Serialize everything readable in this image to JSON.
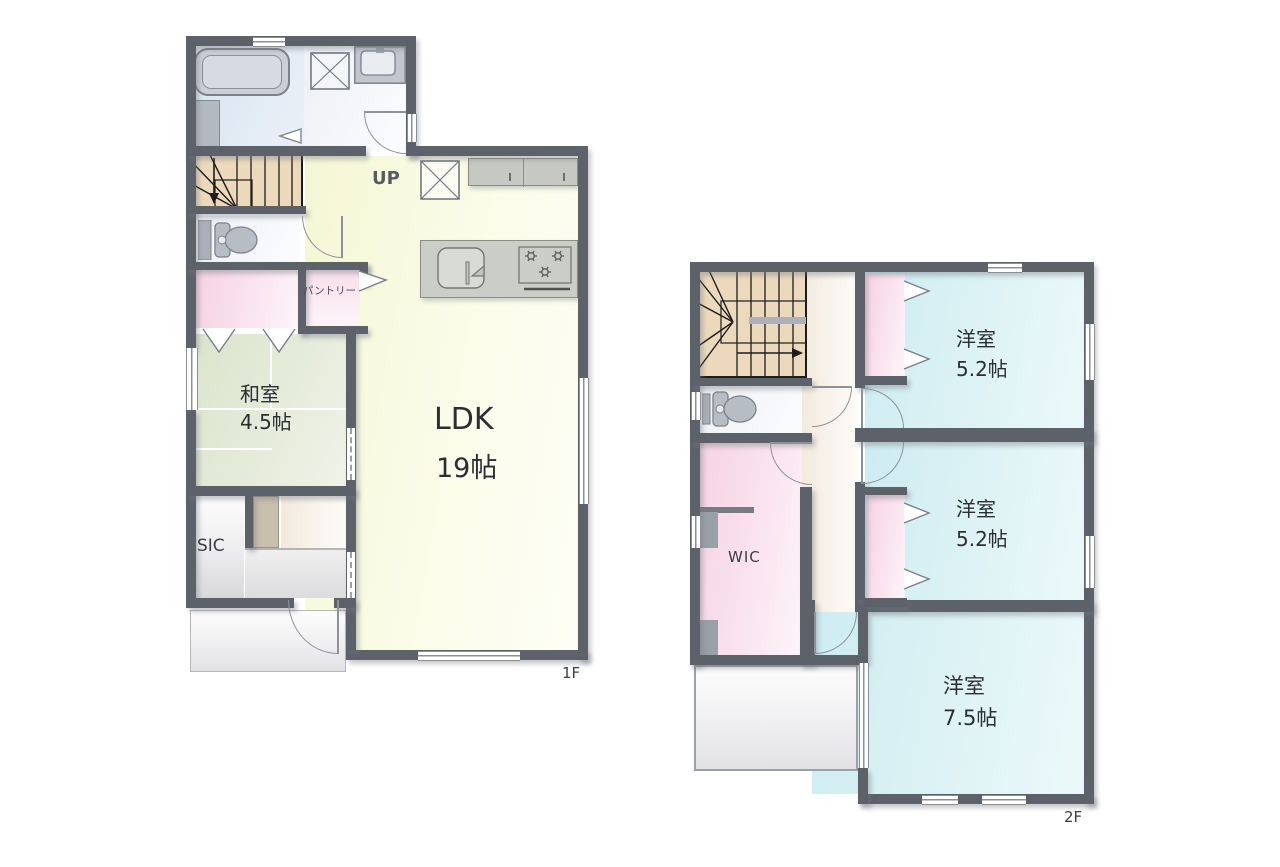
{
  "plan": {
    "floors": [
      {
        "label": "1F",
        "rooms": {
          "ldk": {
            "name": "LDK",
            "size": "19帖"
          },
          "washitsu": {
            "name": "和室",
            "size": "4.5帖"
          },
          "sic": {
            "name": "SIC"
          },
          "pantry": {
            "name": "パントリー"
          },
          "stairs": {
            "name": "UP"
          }
        }
      },
      {
        "label": "2F",
        "rooms": {
          "west1": {
            "name": "洋室",
            "size": "5.2帖"
          },
          "west2": {
            "name": "洋室",
            "size": "5.2帖"
          },
          "west3": {
            "name": "洋室",
            "size": "7.5帖"
          },
          "wic": {
            "name": "WIC"
          }
        }
      }
    ],
    "colors": {
      "wall": "#5c616a",
      "ldk_floor": "#f4f7d4",
      "tatami_floor": "#dbe4cd",
      "western_floor": "#cdecf1",
      "closet_pink": "#f6d2e2",
      "stair_tan": "#ecd9bb",
      "bath_blue": "#d9e4f0",
      "hall_beige": "#f1e9db"
    }
  }
}
